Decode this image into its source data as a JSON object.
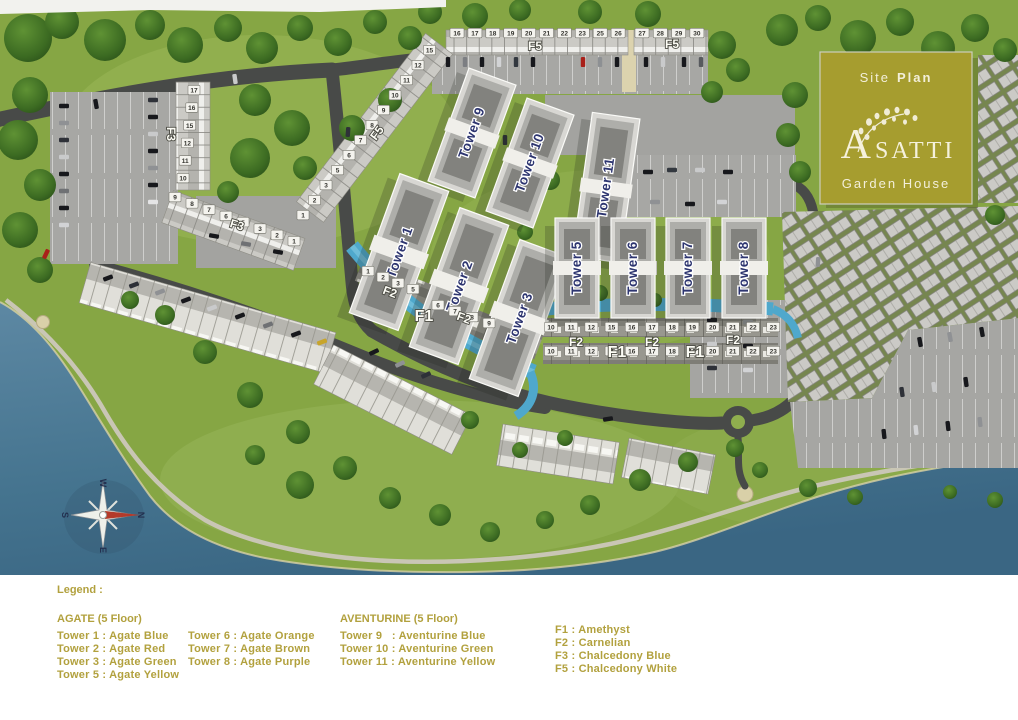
{
  "logo": {
    "site_plan_1": "Site",
    "site_plan_2": "Plan",
    "brand_initial": "A",
    "brand_rest": "SATTI",
    "subtitle": "Garden House",
    "box_color": "#a69d2f",
    "text_color": "#f5f1dc"
  },
  "map": {
    "towers": {
      "t1": "Tower 1",
      "t2": "Tower 2",
      "t3": "Tower 3",
      "t5": "Tower 5",
      "t6": "Tower 6",
      "t7": "Tower 7",
      "t8": "Tower 8",
      "t9": "Tower 9",
      "t10": "Tower 10",
      "t11": "Tower 11"
    },
    "f_labels": {
      "north_west": "F5",
      "north_east": "F5",
      "diagonal": "F5",
      "west_vertical": "F3",
      "west_diagonal": "F3",
      "w_upper": "F2",
      "w_f1": "F1",
      "w_lower": "F2",
      "e1": "F2",
      "e2": "F2",
      "e3": "F2",
      "e_f1a": "F1",
      "e_f1b": "F1"
    },
    "compass": {
      "north": "N",
      "south": "S",
      "east": "E",
      "west": "W"
    },
    "unit_rows": {
      "north_west": [
        "16",
        "17",
        "18",
        "19",
        "20",
        "21",
        "22",
        "23",
        "25",
        "26"
      ],
      "north_east": [
        "27",
        "28",
        "29",
        "30"
      ],
      "f5_diagonal": [
        "1",
        "2",
        "3",
        "5",
        "6",
        "7",
        "8",
        "9",
        "10",
        "11",
        "12",
        "15"
      ],
      "f3_vertical": [
        "17",
        "16",
        "15",
        "12",
        "11",
        "10"
      ],
      "f3_diagonal": [
        "9",
        "8",
        "7",
        "6",
        "5",
        "3",
        "2",
        "1"
      ],
      "f2_west_upper": [
        "1",
        "2",
        "3",
        "5"
      ],
      "f2_west_lower": [
        "6",
        "7",
        "8",
        "9"
      ],
      "east_upper": [
        "10",
        "11",
        "12",
        "15",
        "16",
        "17",
        "18",
        "19",
        "20",
        "21",
        "22",
        "23"
      ],
      "east_lower": [
        "10",
        "11",
        "12",
        "15",
        "16",
        "17",
        "18",
        "19",
        "20",
        "21",
        "22",
        "23"
      ]
    },
    "colors": {
      "water": "#49769a",
      "grass": "#86a644",
      "road": "#484a48",
      "parking": "#a7a7a4",
      "pool": "#4fa8cc"
    }
  },
  "legend": {
    "title": "Legend :",
    "agate_heading": "AGATE (5 Floor)",
    "agate_col1": [
      "Tower 1 : Agate Blue",
      "Tower 2 : Agate Red",
      "Tower 3 : Agate Green",
      "Tower 5 : Agate Yellow"
    ],
    "agate_col2": [
      "Tower 6 : Agate Orange",
      "Tower 7 : Agate Brown",
      "Tower 8 : Agate Purple"
    ],
    "aventurine_heading": "AVENTURINE (5 Floor)",
    "aventurine_col": [
      "Tower 9   : Aventurine Blue",
      "Tower 10 : Aventurine Green",
      "Tower 11 : Aventurine Yellow"
    ],
    "f_col": [
      "F1 : Amethyst",
      "F2 : Carnelian",
      "F3 : Chalcedony Blue",
      "F5 : Chalcedony White"
    ],
    "text_color": "#b2a13e"
  }
}
